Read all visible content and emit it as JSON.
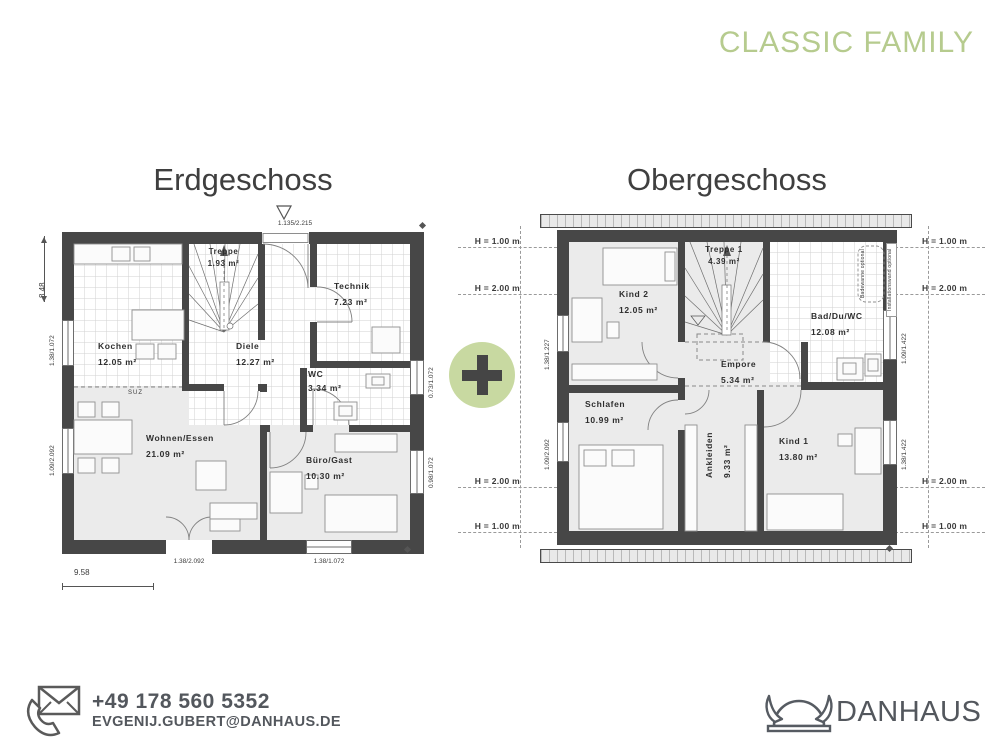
{
  "header": {
    "series_title": "CLASSIC FAMILY"
  },
  "contact": {
    "phone": "+49 178 560 5352",
    "email": "EVGENIJ.GUBERT@DANHAUS.DE"
  },
  "logo": {
    "text": "DANHAUS"
  },
  "icons": {
    "contact_icon": "phone-envelope",
    "logo_icon": "viking-helmet",
    "plus_icon": "plus",
    "entrance_icon": "triangle-down",
    "survey_marker": "diamond"
  },
  "colors": {
    "accent_green": "#b6cb8e",
    "badge_green": "#c8d9a1",
    "wall": "#474747",
    "text_dark": "#3f3f3f",
    "logo_gray": "#53575d"
  },
  "erdgeschoss": {
    "title": "Erdgeschoss",
    "rooms": [
      {
        "name": "Kochen",
        "area": "12.05 m²"
      },
      {
        "name": "Treppe",
        "area": "1.93 m²"
      },
      {
        "name": "Technik",
        "area": "7.23 m²"
      },
      {
        "name": "Diele",
        "area": "12.27 m²"
      },
      {
        "name": "WC",
        "area": "3.34 m²"
      },
      {
        "name": "Wohnen/Essen",
        "area": "21.09 m²"
      },
      {
        "name": "Büro/Gast",
        "area": "10.30 m²"
      }
    ],
    "annotations": {
      "suz": "SUZ",
      "entrance_dim": "1.135/2.215"
    },
    "dimensions": {
      "height_total": "8.48",
      "width_total": "9.58",
      "left_top_window": "1.38/1.072",
      "left_bottom_window": "1.09/2.092",
      "right_top_window": "0.73/1.072",
      "right_bottom_window": "0.98/1.072",
      "bottom_door": "1.38/2.092",
      "bottom_window": "1.38/1.072"
    }
  },
  "obergeschoss": {
    "title": "Obergeschoss",
    "rooms": [
      {
        "name": "Kind 2",
        "area": "12.05 m²"
      },
      {
        "name": "Treppe 1",
        "area": "4.39 m²"
      },
      {
        "name": "Bad/Du/WC",
        "area": "12.08 m²"
      },
      {
        "name": "Empore",
        "area": "5.34 m²"
      },
      {
        "name": "Schlafen",
        "area": "10.99 m²"
      },
      {
        "name": "Ankleiden",
        "area": "9.33 m²"
      },
      {
        "name": "Kind 1",
        "area": "13.80 m²"
      }
    ],
    "annotations": {
      "bathtub": "Badewanne optional",
      "installation_wall": "Installationswand optional"
    },
    "height_labels": {
      "h100": "H = 1.00 m",
      "h200": "H = 2.00 m"
    },
    "dimensions": {
      "left_top_window": "1.38/1.227",
      "left_bottom_window": "1.09/2.092",
      "right_top_window": "1.09/1.422",
      "right_bottom_window": "1.38/1.422"
    }
  }
}
